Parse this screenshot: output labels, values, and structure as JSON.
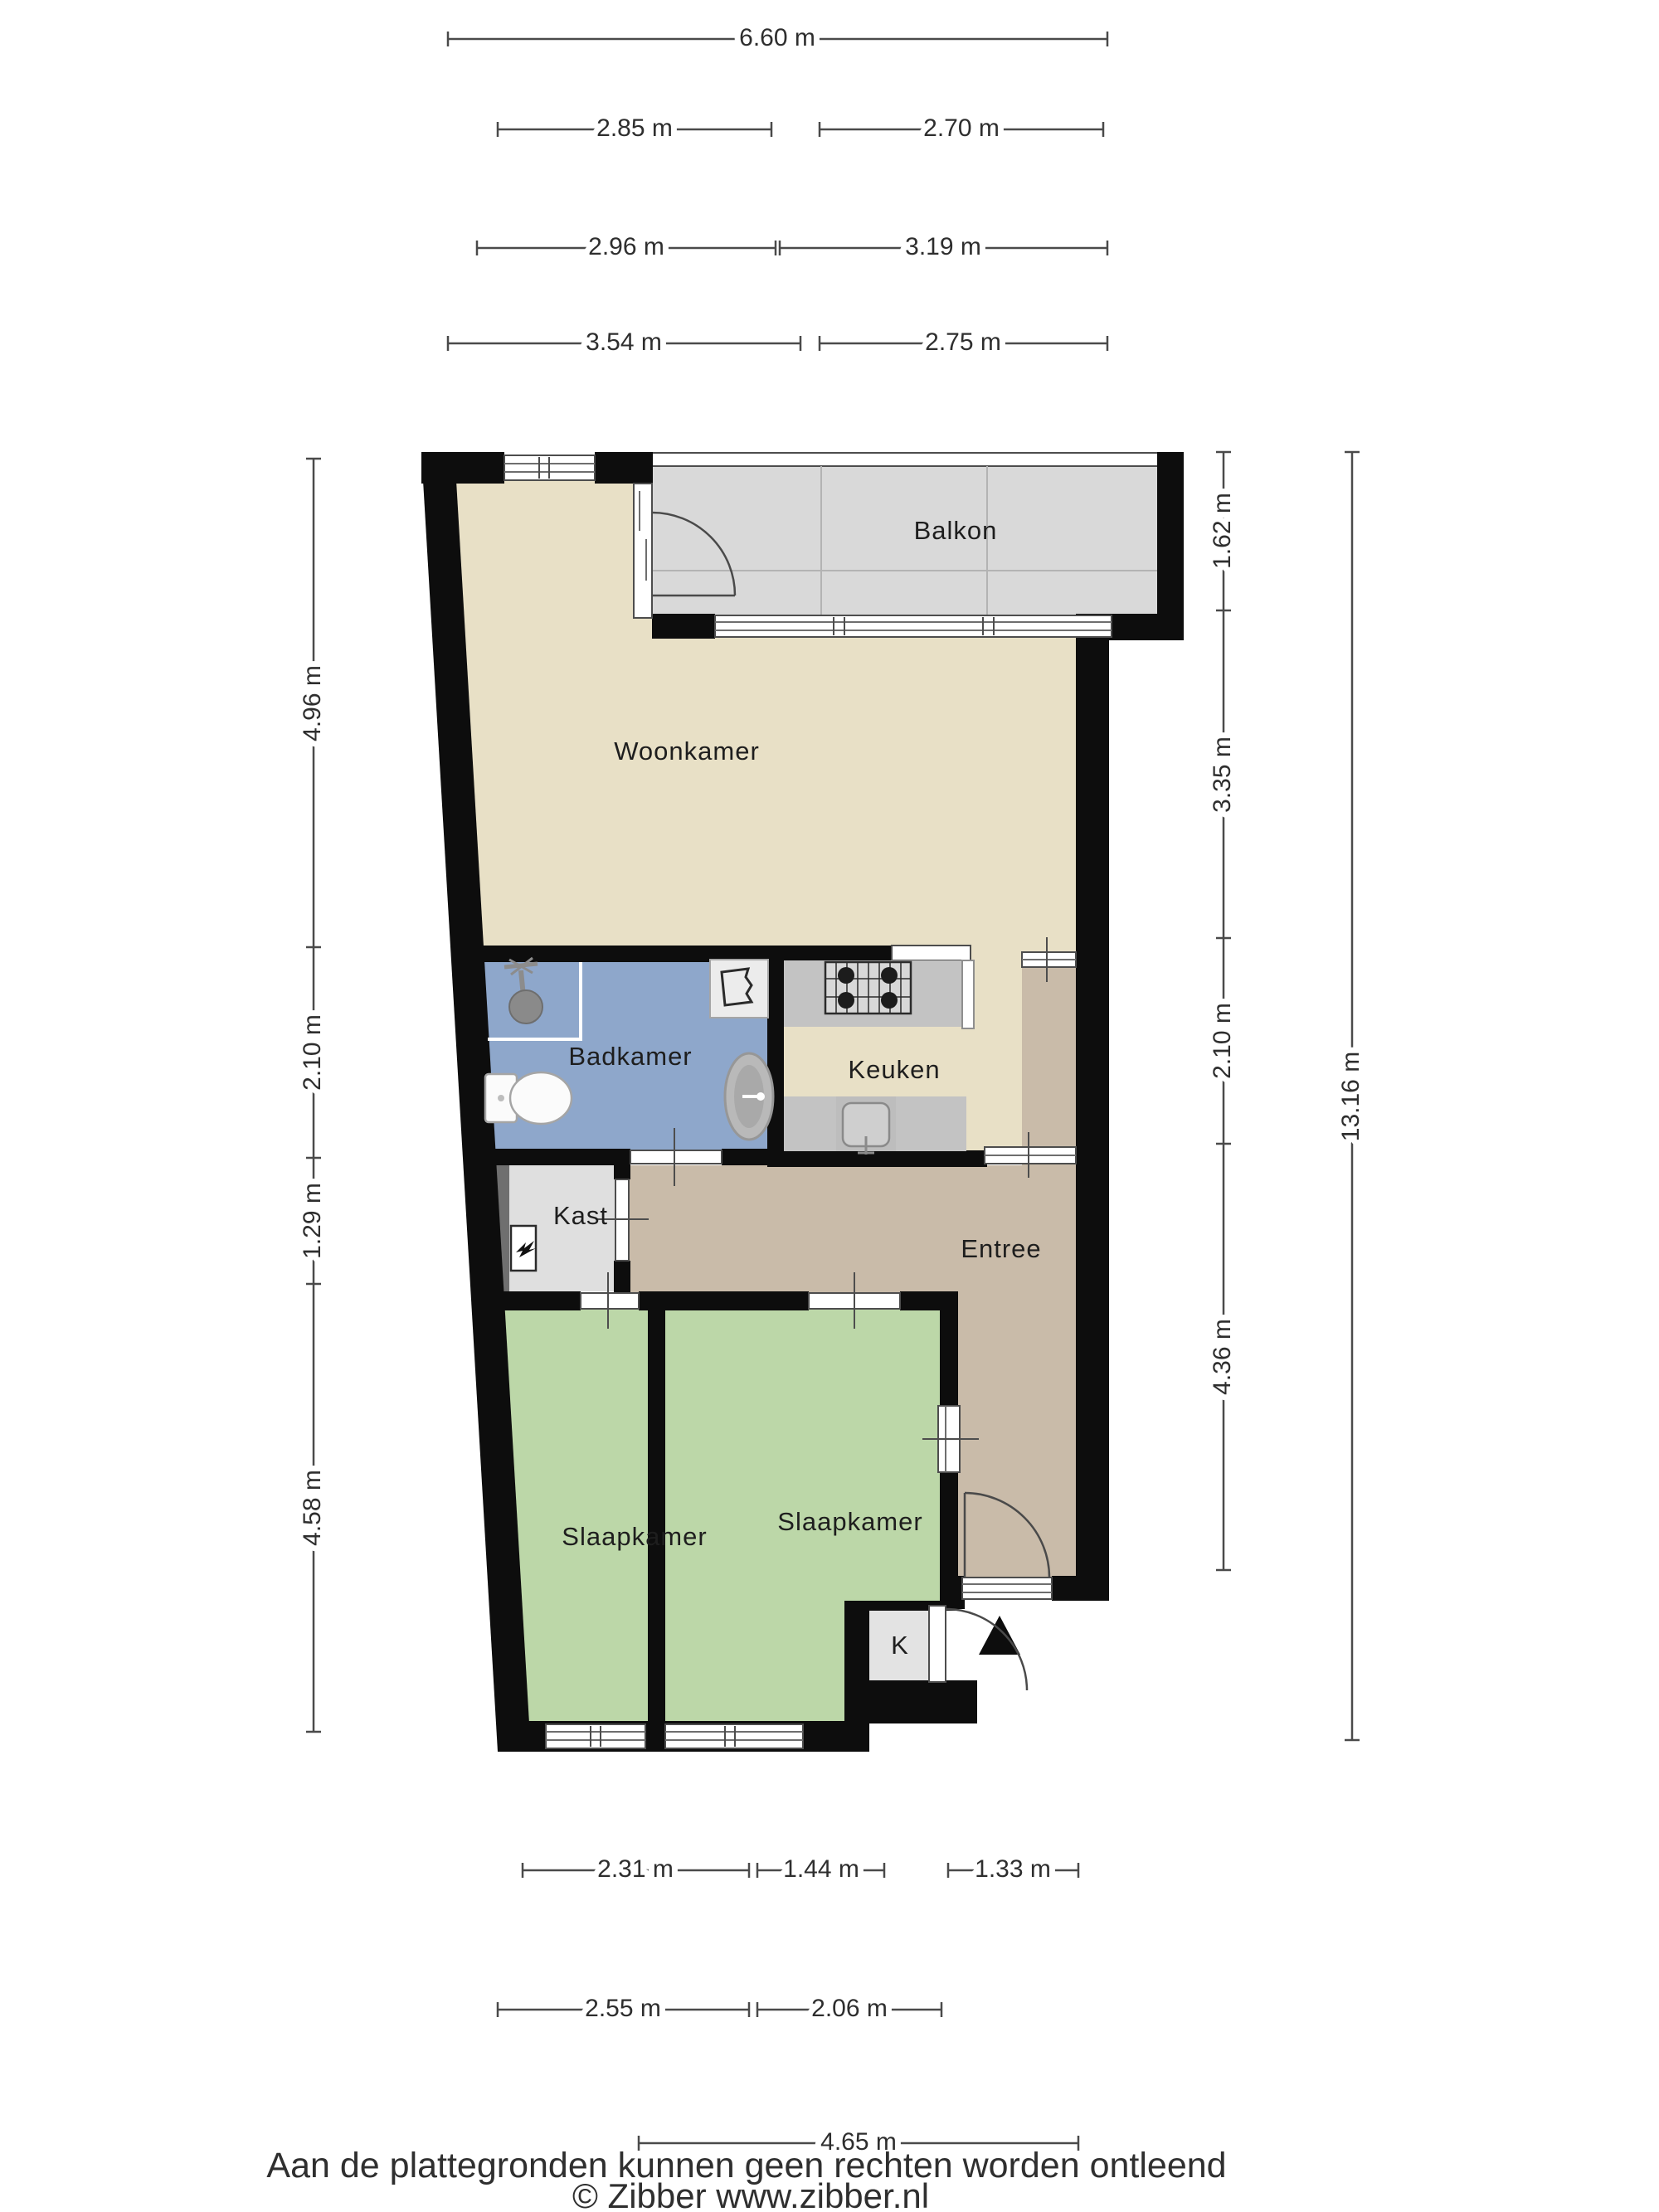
{
  "rooms": {
    "balkon": {
      "label": "Balkon"
    },
    "woonkamer": {
      "label": "Woonkamer"
    },
    "badkamer": {
      "label": "Badkamer"
    },
    "keuken": {
      "label": "Keuken"
    },
    "kast": {
      "label": "Kast"
    },
    "entree": {
      "label": "Entree"
    },
    "slaapkamer1": {
      "label": "Slaapkamer"
    },
    "slaapkamer2": {
      "label": "Slaapkamer"
    },
    "k_closet": {
      "label": "K"
    }
  },
  "dimensions": {
    "top": [
      "6.60 m",
      "2.85 m",
      "2.70 m",
      "2.96 m",
      "3.19 m",
      "3.54 m",
      "2.75 m"
    ],
    "left": [
      "4.96 m",
      "2.10 m",
      "1.29 m",
      "4.58 m"
    ],
    "right": [
      "1.62 m",
      "3.35 m",
      "2.10 m",
      "4.36 m"
    ],
    "right_total": "13.16 m",
    "bottom": [
      "2.31 m",
      "1.44 m",
      "1.33 m",
      "2.55 m",
      "2.06 m",
      "4.65 m"
    ]
  },
  "footer": {
    "disclaimer": "Aan de plattegronden kunnen geen rechten worden ontleend",
    "credit": "© Zibber www.zibber.nl"
  },
  "icons": {
    "entrance_marker": "black-triangle-up",
    "ventilation_unit": "zigzag-glyph",
    "shower_head": "circle-with-arm"
  },
  "colors": {
    "wall": "#0d0d0d",
    "woonkamer": "#e8e0c6",
    "keuken": "#e8e0c6",
    "entree": "#c9bba9",
    "slaapkamer": "#bcd7a8",
    "badkamer": "#8ea7cb",
    "balkon": "#d9d9d9",
    "kast": "#dfdfdf",
    "kast_shaft": "#6f6f6f",
    "counter": "#c3c3c3",
    "k_closet": "#e3e3e3",
    "stove": "#d8d8d8",
    "sink": "#cfcfcf",
    "basin": "#b9b9b9"
  }
}
